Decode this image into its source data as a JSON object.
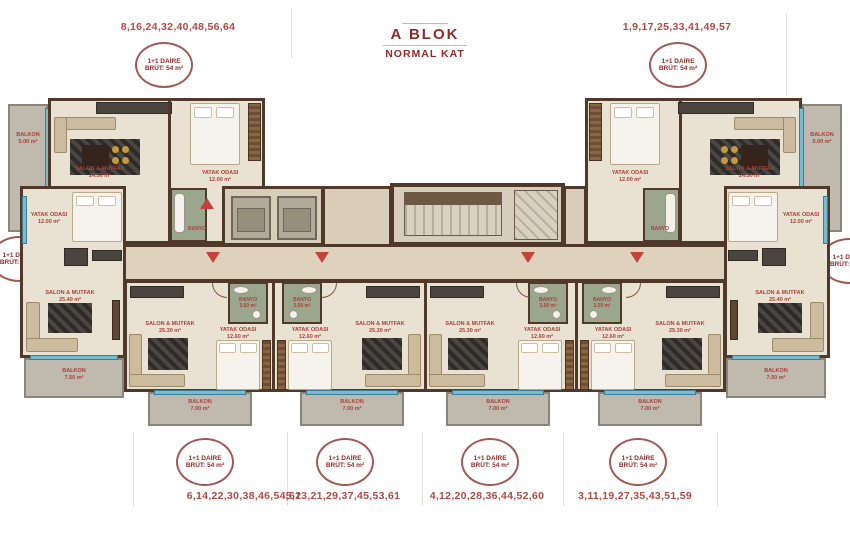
{
  "header": {
    "title": "A BLOK",
    "subtitle": "NORMAL KAT"
  },
  "unit_groups": {
    "top_left": "8,16,24,32,40,48,56,64",
    "top_right": "1,9,17,25,33,41,49,57",
    "bottom_1": "6,14,22,30,38,46,54,62",
    "bottom_2": "5,13,21,29,37,45,53,61",
    "bottom_3": "4,12,20,28,36,44,52,60",
    "bottom_4": "3,11,19,27,35,43,51,59"
  },
  "badges": {
    "type_54": {
      "line1": "1+1 DAİRE",
      "line2": "BRÜT: 54 m²"
    },
    "type_56": {
      "line1": "1+1 DAİRE",
      "line2": "BRÜT: 56 m²"
    }
  },
  "labels": {
    "salon_top": {
      "name": "SALON & MUTFAK",
      "area": "24.50 m²"
    },
    "salon_side": {
      "name": "SALON & MUTFAK",
      "area": "25.40 m²"
    },
    "salon_bottom": {
      "name": "SALON & MUTFAK",
      "area": "25.30 m²"
    },
    "bedroom_top": {
      "name": "YATAK ODASI",
      "area": "12.00 m²"
    },
    "bedroom_side": {
      "name": "YATAK ODASI",
      "area": "12.00 m²"
    },
    "bedroom_bottom": {
      "name": "YATAK ODASI",
      "area": "12.60 m²"
    },
    "bath": {
      "name": "BANYO",
      "area": "3.50 m²"
    },
    "balcony_side": {
      "name": "BALKON",
      "area": "5.00 m²"
    },
    "balcony_corner": {
      "name": "BALKON",
      "area": "7.50 m²"
    },
    "balcony_bottom": {
      "name": "BALKON",
      "area": "7.00 m²"
    }
  },
  "colors": {
    "accent_red": "#a8403a",
    "title_red": "#8e2a28",
    "wall_brown": "#50392a",
    "floor_beige": "#e9e1d1",
    "balcony_gray": "#bfbaad",
    "window_blue": "#76bdd3",
    "tile_green": "#9aa78c"
  }
}
